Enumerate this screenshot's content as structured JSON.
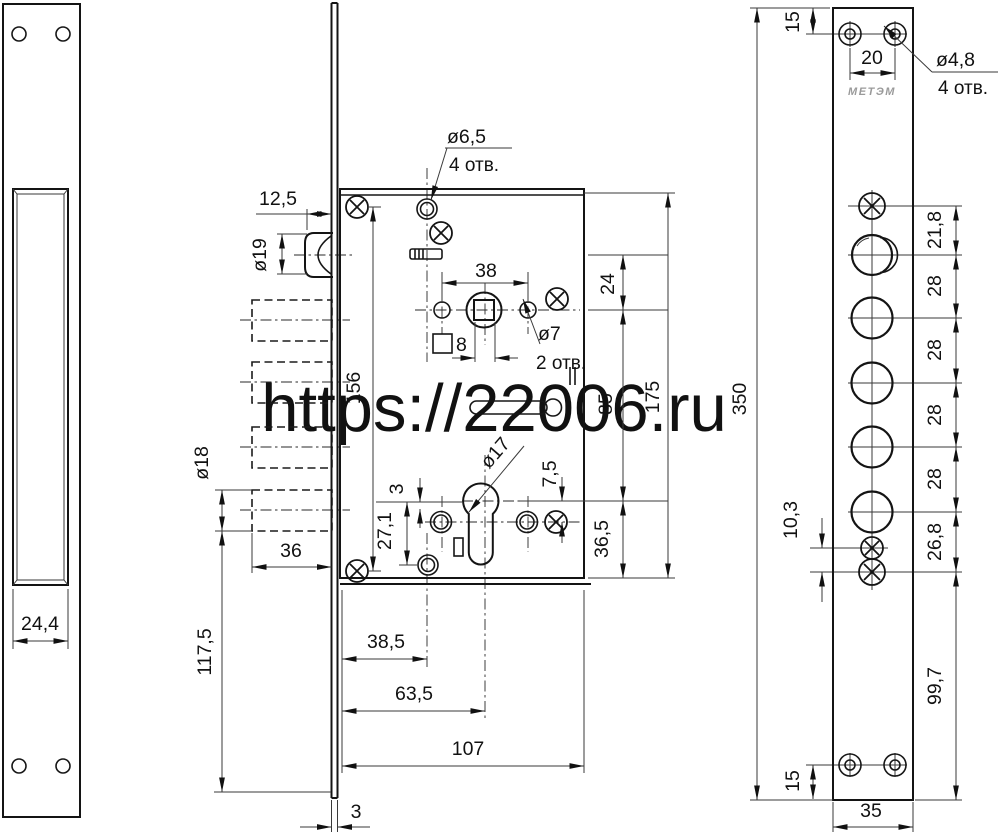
{
  "watermark": {
    "text": "https://22006.ru",
    "color": "#ee1111"
  },
  "left_view": {
    "pocket_width": "24,4"
  },
  "middle_view": {
    "latch_protrusion": "12,5",
    "latch_diameter": "ø19",
    "mount_hole_diameter": "ø6,5",
    "mount_hole_count": "4 отв.",
    "handle_hole_span": "38",
    "handle_hole_diameter": "ø7",
    "handle_hole_count": "2 отв.",
    "spindle_square": "8",
    "latch_to_spindle": "24",
    "spindle_to_cylinder": "85",
    "cylinder_to_bottom": "36,5",
    "case_height": "175",
    "screw_span": "156",
    "cylinder_diameter": "ø17",
    "cylinder_offset": "7,5",
    "offset_3": "3",
    "cylinder_to_hole": "27,1",
    "bolt_diameter": "ø18",
    "bolt_throw": "36",
    "bolt_to_plate_end": "117,5",
    "backset_1": "38,5",
    "backset_2": "63,5",
    "case_depth": "107",
    "faceplate_thickness": "3"
  },
  "right_view": {
    "brand_logo": "МЕТЭМ",
    "edge_to_holes_top": "15",
    "top_hole_span": "20",
    "top_hole_diameter": "ø4,8",
    "top_hole_count": "4 отв.",
    "screw_to_latch": "21,8",
    "bolt_pitches": [
      "28",
      "28",
      "28",
      "28"
    ],
    "bolt_to_screws": "26,8",
    "screw_gap": "10,3",
    "screws_to_bottom": "99,7",
    "edge_to_holes_bottom": "15",
    "plate_width": "35",
    "plate_height": "350"
  }
}
